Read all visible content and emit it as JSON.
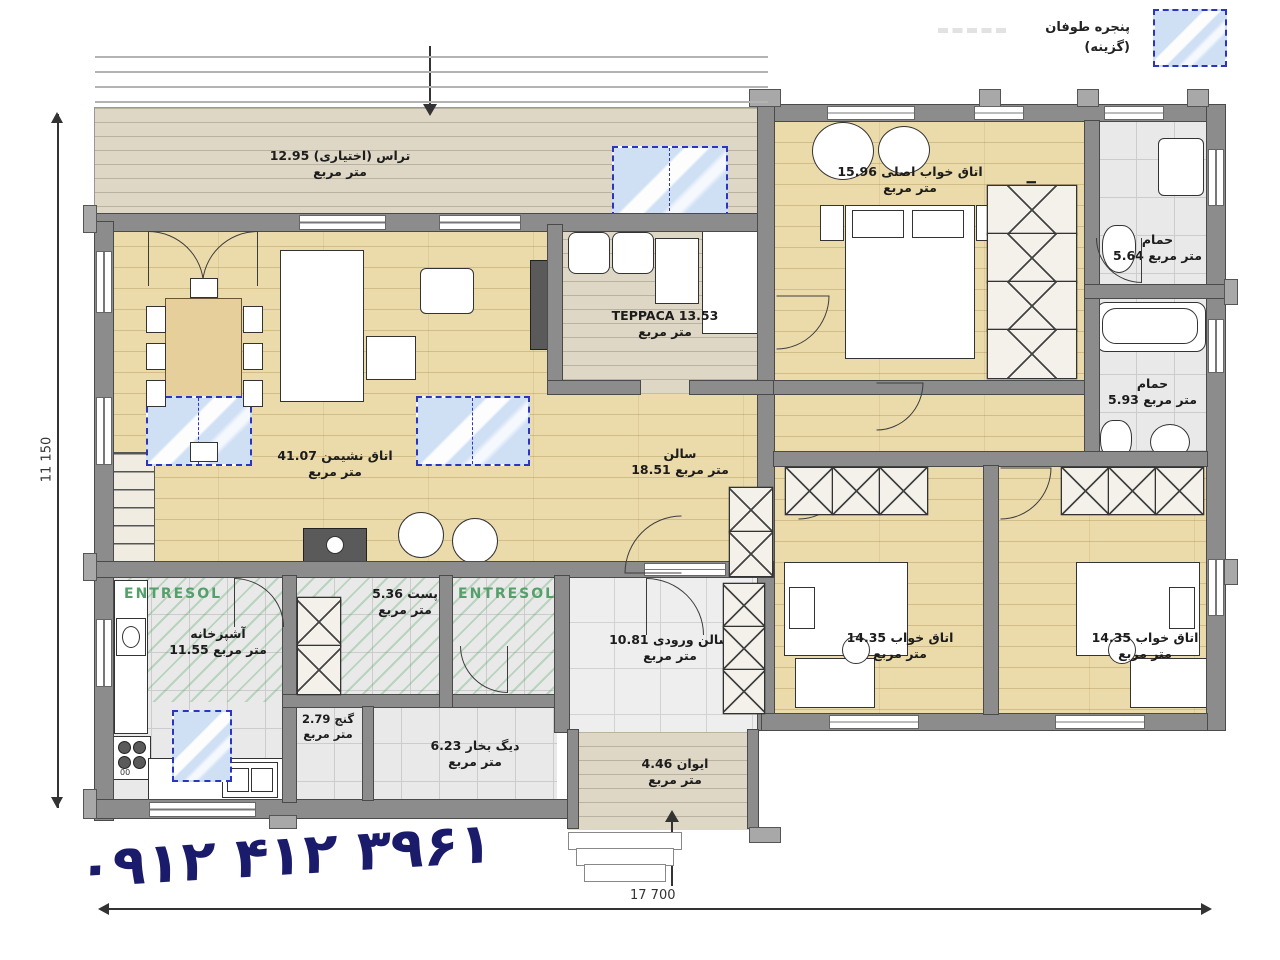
{
  "legend": {
    "title": "پنجره طوفان",
    "subtitle": "(گزینه)"
  },
  "phone_number": "۰۹۱۲ ۴۱۲ ۳۹۶۱",
  "dimensions": {
    "height_label": "11 150",
    "width_label": "17 700"
  },
  "area_unit": "متر مربع",
  "annotations": {
    "entresol": "ENTRESOL",
    "stove_mark": "00"
  },
  "rooms": [
    {
      "name": "تراس (اختیاری)",
      "area": "12.95"
    },
    {
      "name": "اتاق خواب اصلی",
      "area": "15.96"
    },
    {
      "name": "اتاق رختکن",
      "area": "4.42"
    },
    {
      "name": "حمام",
      "area": "5.64"
    },
    {
      "name": "حمام",
      "area": "5.93"
    },
    {
      "name": "TEPPACA",
      "area": "13.53"
    },
    {
      "name": "اتاق نشیمن",
      "area": "41.07"
    },
    {
      "name": "سالن",
      "area": "18.51"
    },
    {
      "name": "آشپزخانه",
      "area": "11.55"
    },
    {
      "name": "پست",
      "area": "5.36"
    },
    {
      "name": "سالن ورودی",
      "area": "10.81"
    },
    {
      "name": "اتاق خواب",
      "area": "14.35"
    },
    {
      "name": "اتاق خواب",
      "area": "14.35"
    },
    {
      "name": "گنج",
      "area": "2.79"
    },
    {
      "name": "دیگ بخار",
      "area": "6.23"
    },
    {
      "name": "ایوان",
      "area": "4.46"
    }
  ],
  "colors": {
    "accent_blue": "#2a35c0",
    "phone_navy": "#1b1b6b",
    "entresol_green": "#55a06a",
    "wood_floor": "#ecdbaa",
    "wall_grey": "#8c8c8c"
  }
}
